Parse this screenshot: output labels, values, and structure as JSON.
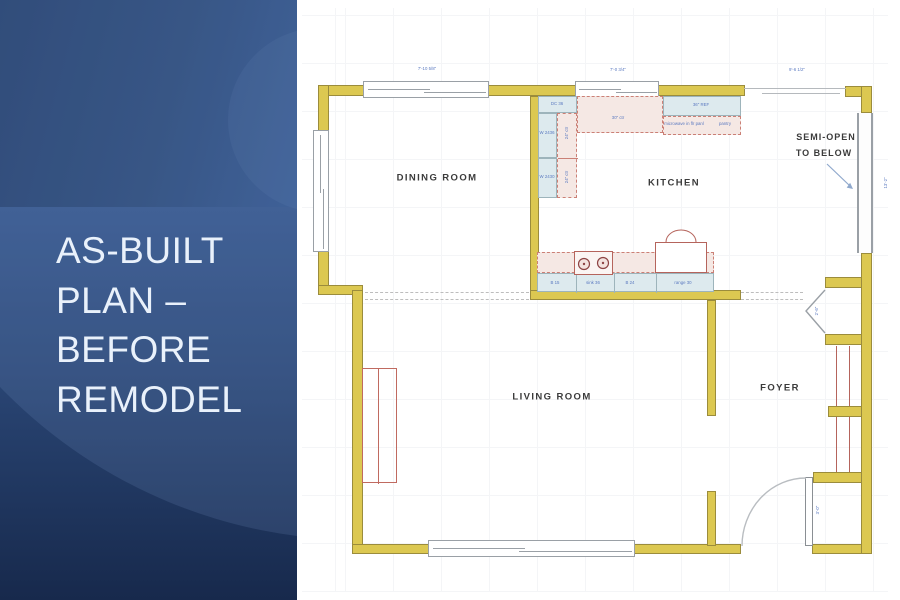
{
  "slide": {
    "title": "AS-BUILT PLAN – BEFORE REMODEL",
    "panel_colors": {
      "band_top": "#2a4877",
      "band_main": "#3a5c95",
      "band_bottom": "#17294c",
      "title_text": "#e9f1fb"
    }
  },
  "plan": {
    "rooms": [
      {
        "name": "DINING ROOM"
      },
      {
        "name": "KITCHEN"
      },
      {
        "name": "LIVING ROOM"
      },
      {
        "name": "FOYER"
      }
    ],
    "semi_open": {
      "line1": "SEMI-OPEN",
      "line2": "TO BELOW"
    },
    "dims": {
      "top1": "7'-10 5/8\"",
      "top2": "7'-0 3/4\"",
      "top3": "9'-6 1/2\"",
      "right": "13'-2\"",
      "closet": "2'-6\"",
      "door": "3'-0\""
    },
    "cabinets": {
      "corner": "DC 36",
      "wall_a1": "W 2436",
      "wall_a2": "W 2430",
      "ctr_v1": "24\" ctr",
      "ctr_v2": "24\" ctr",
      "counter_top": "30\" ctr",
      "fridge": "36\" REF",
      "under_fridge_1": "microwave in flr panl",
      "under_fridge_2": "pantry",
      "base_1": "B 15",
      "base_2": "sink 36",
      "base_3": "B 24",
      "base_4": "range 30"
    },
    "colors": {
      "wall": "#dcc851",
      "cabinet": "#ddeaee",
      "counter": "#f5e8e4",
      "dim_text": "#5a79c0"
    }
  }
}
